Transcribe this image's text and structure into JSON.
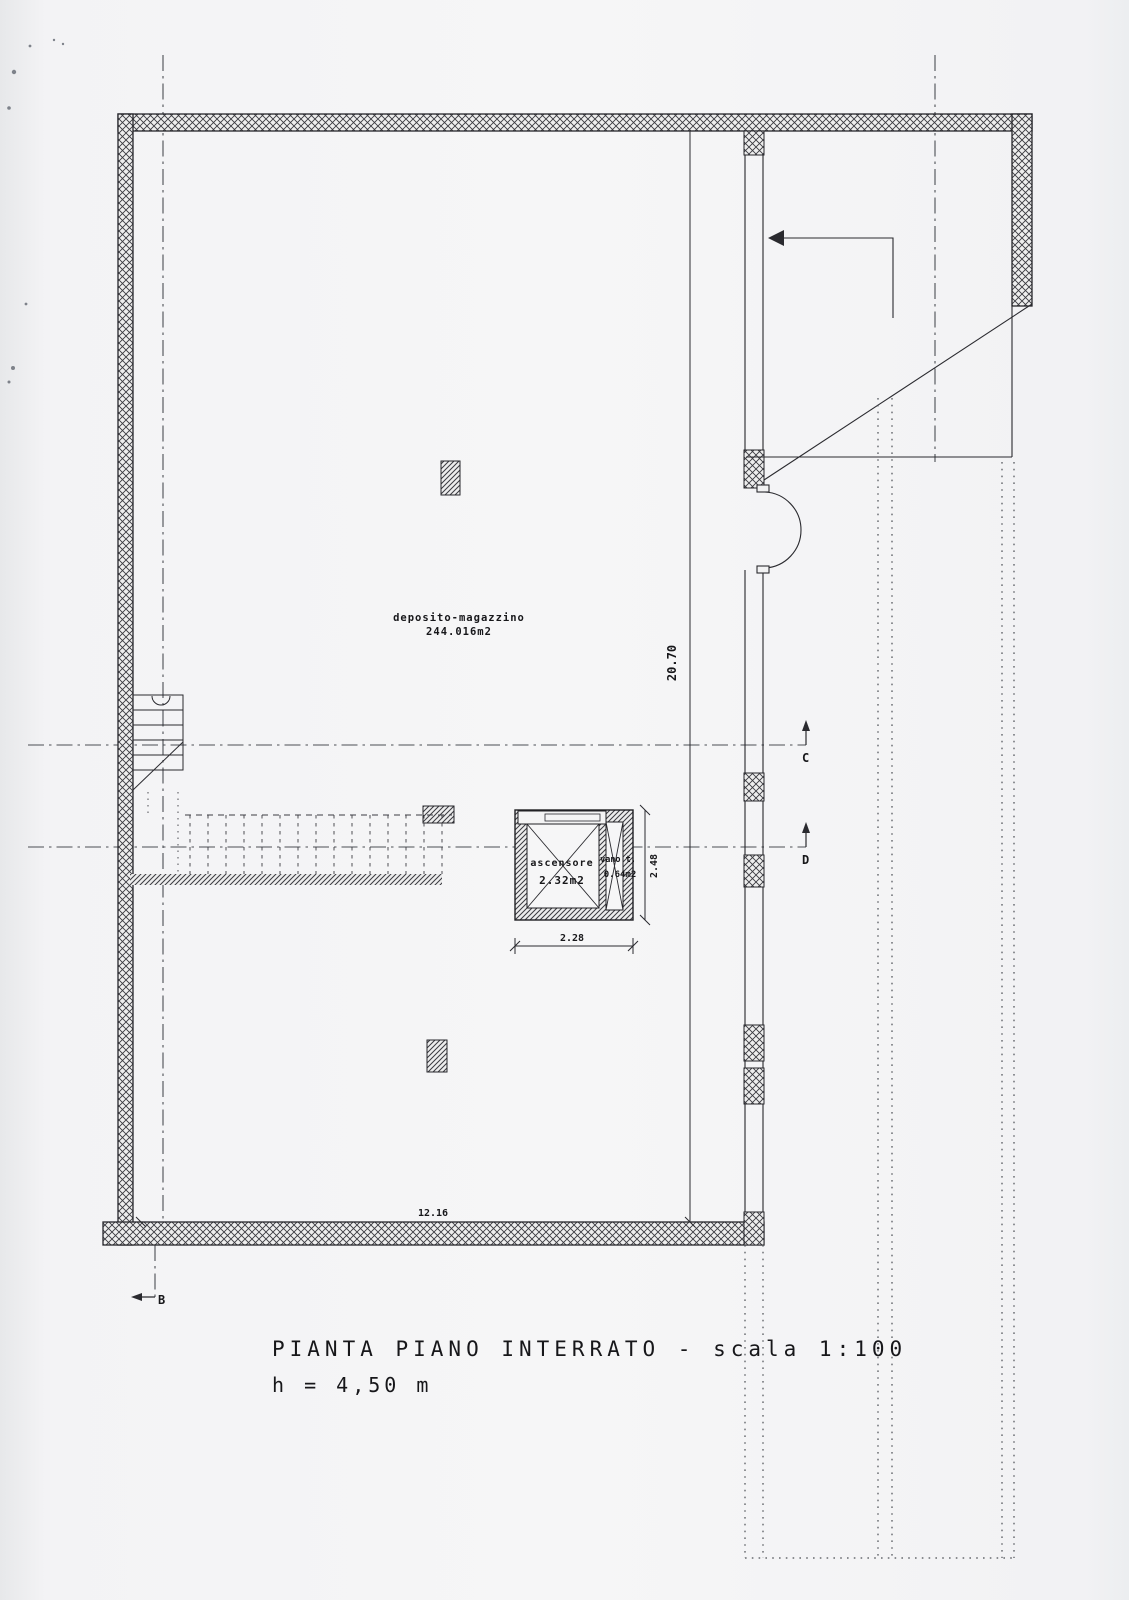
{
  "title_block": {
    "title": "PIANTA PIANO INTERRATO - scala 1:100",
    "height_note": "h = 4,50 m"
  },
  "rooms": {
    "storage_name": "deposito-magazzino",
    "storage_area": "244.016m2",
    "elevator_name": "ascensore",
    "elevator_area": "2.32m2",
    "shaft_name": "vano t.",
    "shaft_area": "0.64m2"
  },
  "dimensions": {
    "overall_depth": "20.70",
    "overall_width": "12.16",
    "elevator_width": "2.28",
    "elevator_depth": "2.48"
  },
  "section_markers": {
    "c": "C",
    "d": "D",
    "b": "B"
  }
}
